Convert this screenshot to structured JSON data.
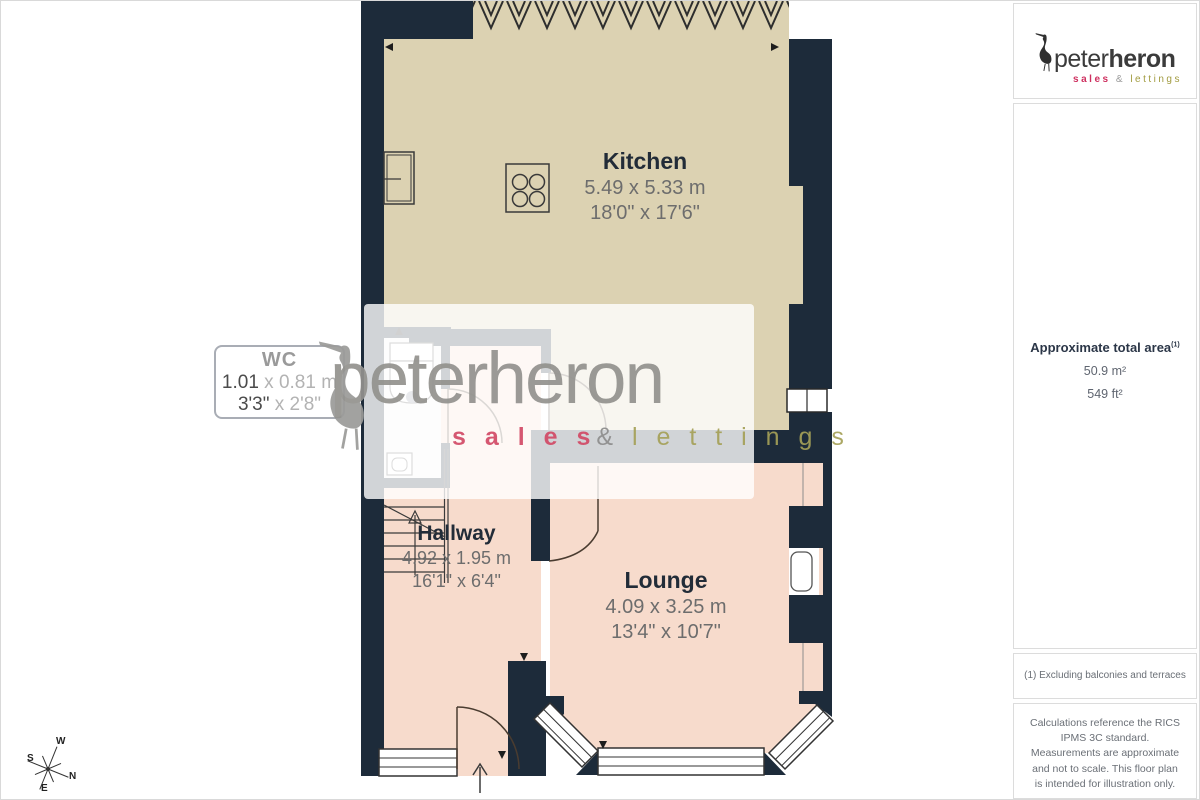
{
  "branding": {
    "logo": {
      "peter": "peter",
      "heron": "heron",
      "sales": "sales",
      "amp": "&",
      "lettings": "lettings"
    },
    "watermark": {
      "name": "peterheron",
      "sales": "s a l e s",
      "amp": "&",
      "lettings": "l e t t i n g s"
    }
  },
  "sidebar": {
    "area": {
      "title": "Approximate total area",
      "superscript": "(1)",
      "sqm": "50.9 m²",
      "sqft": "549 ft²"
    },
    "note": "(1) Excluding balconies and terraces",
    "disclaimer": "Calculations reference the RICS IPMS 3C standard. Measurements are approximate and not to scale. This floor plan is intended for illustration only.",
    "giraffe": {
      "name": "GIRAFFE",
      "num": "360"
    }
  },
  "rooms": {
    "kitchen": {
      "name": "Kitchen",
      "metric": "5.49 x 5.33 m",
      "imperial": "18'0\" x 17'6\""
    },
    "wc": {
      "name": "WC",
      "metric_a": "1.01",
      "metric_b": " x 0.81 m",
      "imperial_a": "3'3\"",
      "imperial_b": " x 2'8\""
    },
    "hallway": {
      "name": "Hallway",
      "metric": "4.92 x 1.95 m",
      "imperial": "16'1\" x 6'4\""
    },
    "lounge": {
      "name": "Lounge",
      "metric": "4.09 x 3.25 m",
      "imperial": "13'4\" x 10'7\""
    }
  },
  "compass": {
    "w": "W",
    "s": "S",
    "n": "N",
    "e": "E"
  },
  "colors": {
    "wall": "#1d2b3a",
    "kitchen_floor": "#dcd2b2",
    "living_floor": "#f7dbcc",
    "brand_pink": "#d24a66",
    "brand_olive": "#a5a158"
  }
}
